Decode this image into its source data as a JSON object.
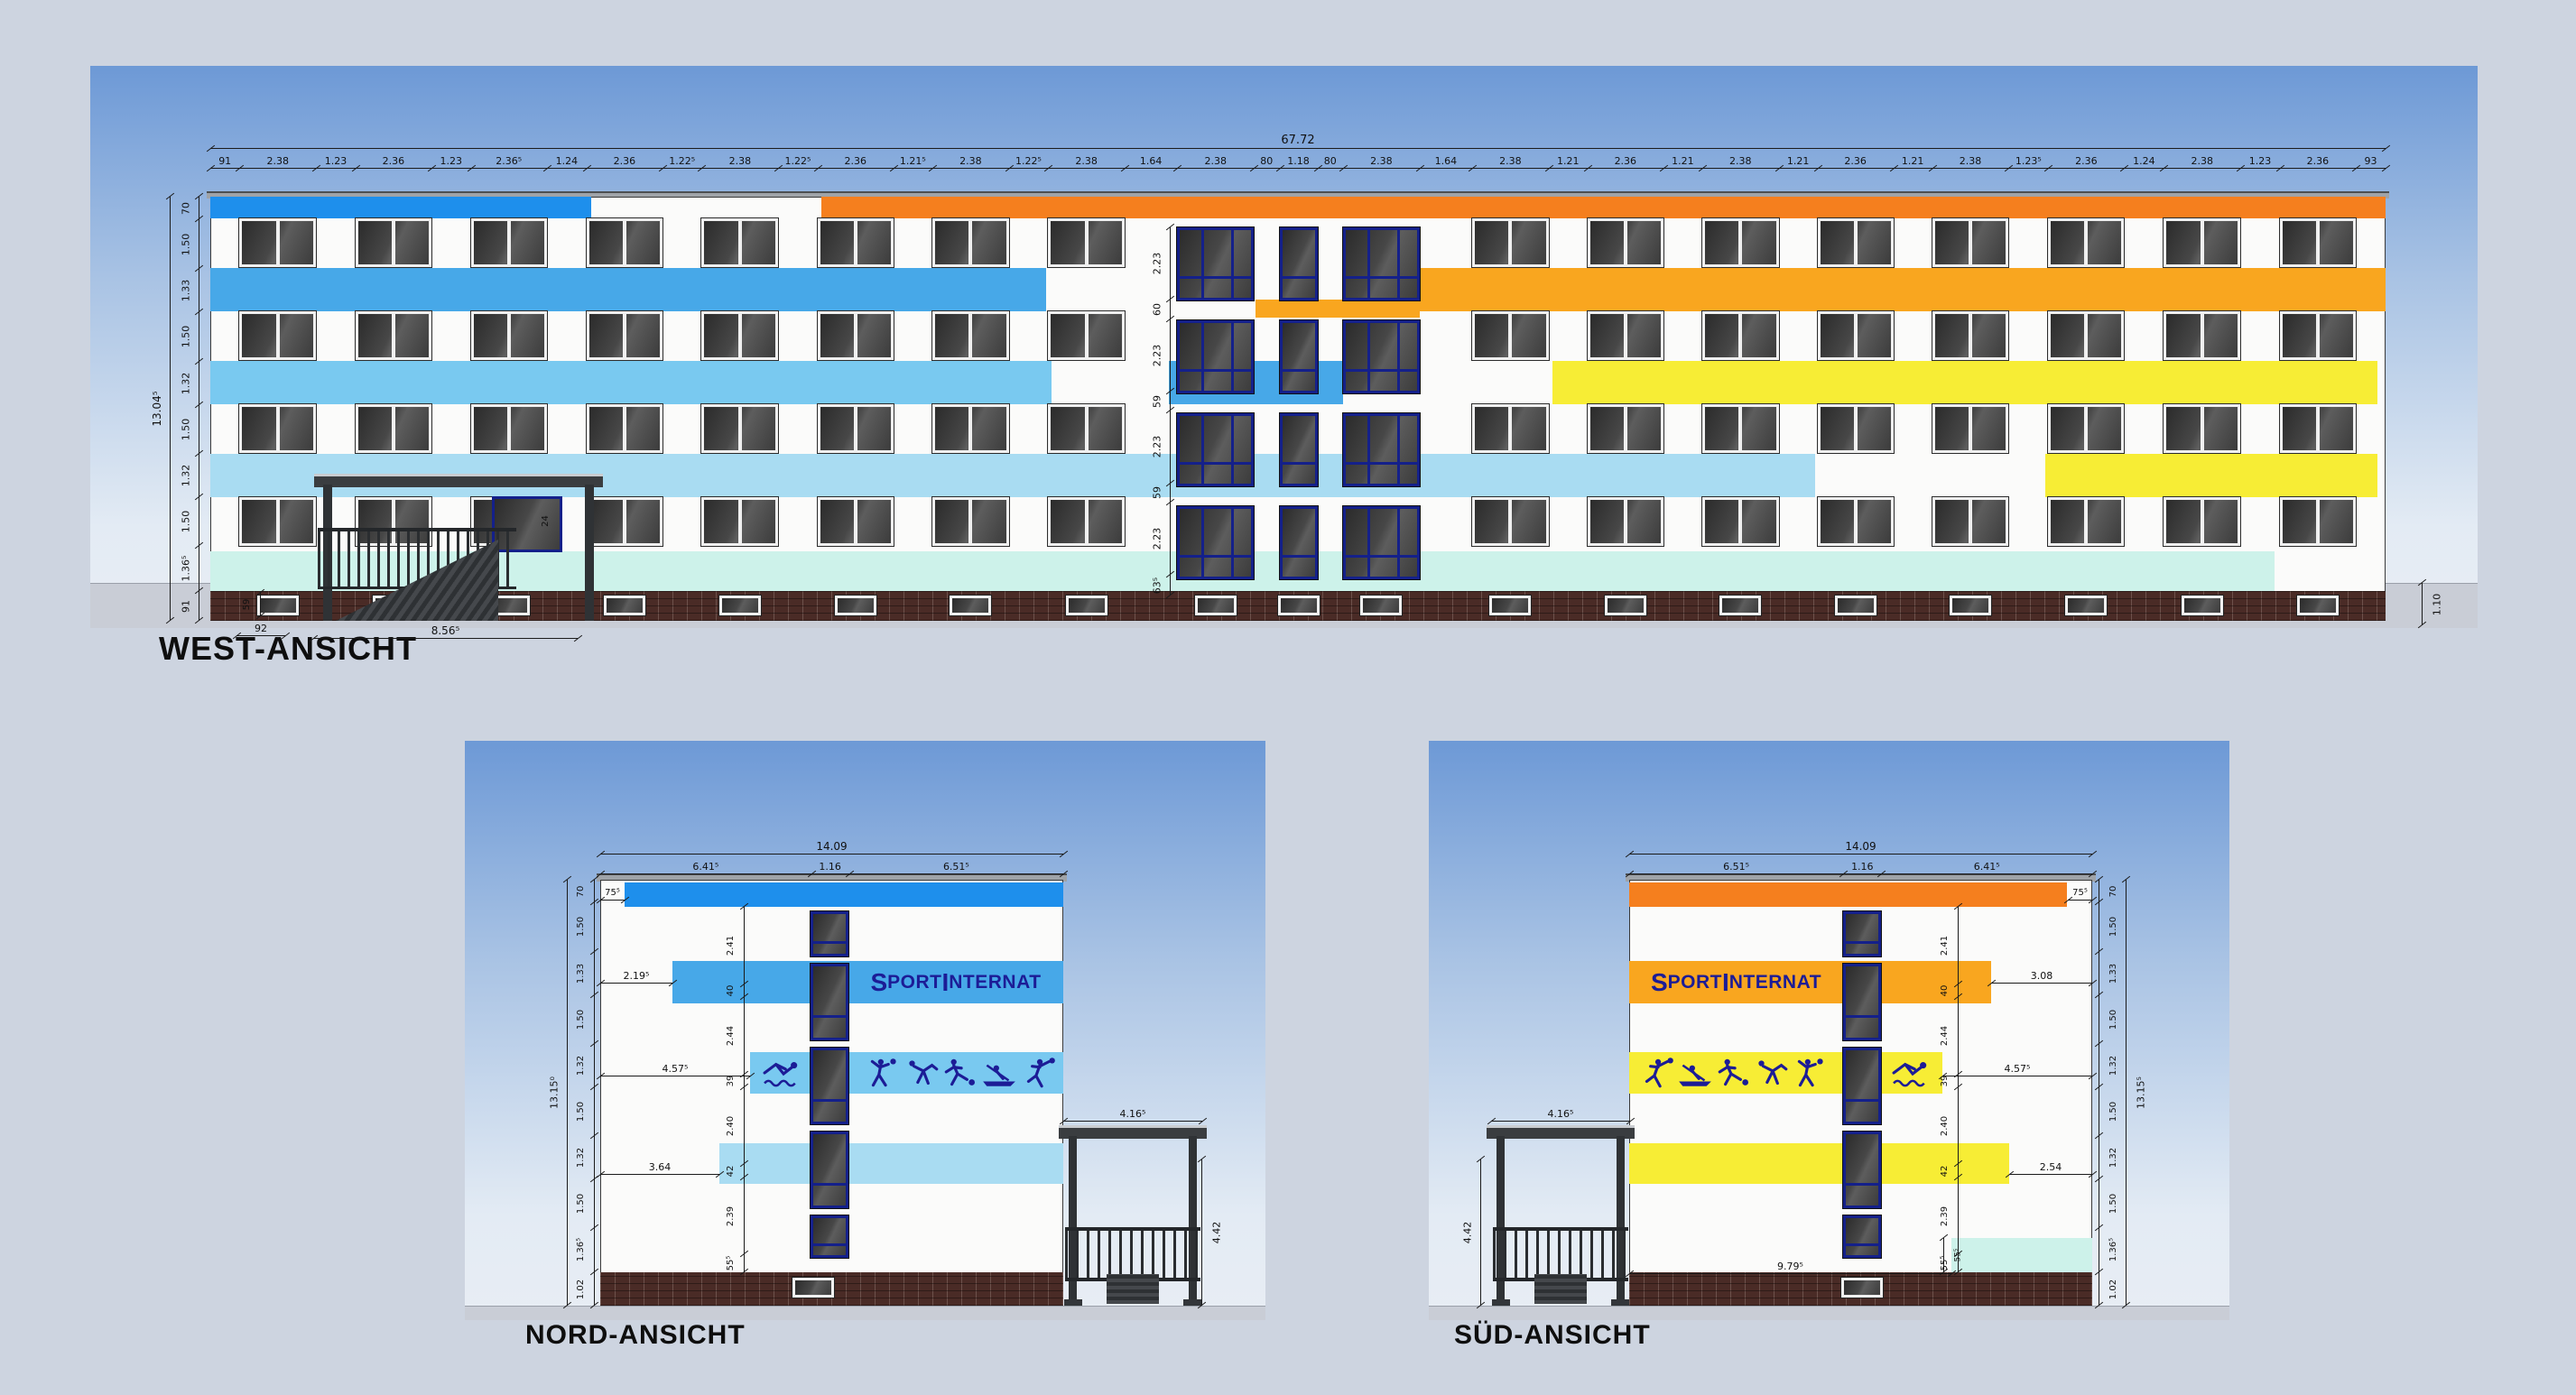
{
  "labels": {
    "west": "WEST-ANSICHT",
    "nord": "NORD-ANSICHT",
    "sued": "SÜD-ANSICHT"
  },
  "branding": {
    "lead": "S",
    "lead_rest": "PORT",
    "second": "I",
    "second_rest": "NTERNAT"
  },
  "colors": {
    "page_bg": "#cdd4e0",
    "sky_top": "#6d99d6",
    "sky_mid": "#a9c3e4",
    "sky_bottom": "#e3ebf4",
    "ground": "#c9cdd6",
    "roof": "#9fa3a8",
    "facade_white": "#fbfbfa",
    "strong_blue": "#1e8fec",
    "sky_blue": "#47a8e8",
    "mid_blue": "#79c9f0",
    "pale_blue": "#a9dcf2",
    "mint": "#cdf2ea",
    "orange": "#f57f1e",
    "amber": "#f9a61f",
    "yellow": "#f7ed35",
    "navy_frame": "#14208a",
    "navy_text": "#1c1c96",
    "brick": "#4a2b26",
    "window_frame": "#f0f0f0",
    "glass_dark": "#3a3a3a",
    "dim_line": "#1b1b1b"
  },
  "west": {
    "total_width": {
      "t": "67.72",
      "v": 67.72
    },
    "total_height": {
      "t": "13.04⁵",
      "v": 13.045
    },
    "top_chain": [
      {
        "t": "91",
        "v": 0.91
      },
      {
        "t": "2.38",
        "v": 2.38
      },
      {
        "t": "1.23",
        "v": 1.23
      },
      {
        "t": "2.36",
        "v": 2.36
      },
      {
        "t": "1.23",
        "v": 1.23
      },
      {
        "t": "2.36⁵",
        "v": 2.365
      },
      {
        "t": "1.24",
        "v": 1.24
      },
      {
        "t": "2.36",
        "v": 2.36
      },
      {
        "t": "1.22⁵",
        "v": 1.225
      },
      {
        "t": "2.38",
        "v": 2.38
      },
      {
        "t": "1.22⁵",
        "v": 1.225
      },
      {
        "t": "2.36",
        "v": 2.36
      },
      {
        "t": "1.21⁵",
        "v": 1.215
      },
      {
        "t": "2.38",
        "v": 2.38
      },
      {
        "t": "1.22⁵",
        "v": 1.225
      },
      {
        "t": "2.38",
        "v": 2.38
      },
      {
        "t": "1.64",
        "v": 1.64
      },
      {
        "t": "2.38",
        "v": 2.38
      },
      {
        "t": "80",
        "v": 0.8
      },
      {
        "t": "1.18",
        "v": 1.18
      },
      {
        "t": "80",
        "v": 0.8
      },
      {
        "t": "2.38",
        "v": 2.38
      },
      {
        "t": "1.64",
        "v": 1.64
      },
      {
        "t": "2.38",
        "v": 2.38
      },
      {
        "t": "1.21",
        "v": 1.21
      },
      {
        "t": "2.36",
        "v": 2.36
      },
      {
        "t": "1.21",
        "v": 1.21
      },
      {
        "t": "2.38",
        "v": 2.38
      },
      {
        "t": "1.21",
        "v": 1.21
      },
      {
        "t": "2.36",
        "v": 2.36
      },
      {
        "t": "1.21",
        "v": 1.21
      },
      {
        "t": "2.38",
        "v": 2.38
      },
      {
        "t": "1.23⁵",
        "v": 1.235
      },
      {
        "t": "2.36",
        "v": 2.36
      },
      {
        "t": "1.24",
        "v": 1.24
      },
      {
        "t": "2.38",
        "v": 2.38
      },
      {
        "t": "1.23",
        "v": 1.23
      },
      {
        "t": "2.36",
        "v": 2.36
      },
      {
        "t": "93",
        "v": 0.93
      }
    ],
    "left_chain": [
      {
        "t": "70",
        "v": 0.7
      },
      {
        "t": "1.50",
        "v": 1.5
      },
      {
        "t": "1.33",
        "v": 1.33
      },
      {
        "t": "1.50",
        "v": 1.5
      },
      {
        "t": "1.32",
        "v": 1.32
      },
      {
        "t": "1.50",
        "v": 1.5
      },
      {
        "t": "1.32",
        "v": 1.32
      },
      {
        "t": "1.50",
        "v": 1.5
      },
      {
        "t": "1.36⁵",
        "v": 1.365
      },
      {
        "t": "91",
        "v": 0.91
      }
    ],
    "center_chain": [
      {
        "t": "2.23",
        "v": 2.23
      },
      {
        "t": "60",
        "v": 0.6
      },
      {
        "t": "2.23",
        "v": 2.23
      },
      {
        "t": "59",
        "v": 0.59
      },
      {
        "t": "2.23",
        "v": 2.23
      },
      {
        "t": "59",
        "v": 0.59
      },
      {
        "t": "2.23",
        "v": 2.23
      },
      {
        "t": "63⁵",
        "v": 0.635
      }
    ],
    "base_dims": {
      "base_left_height": "91",
      "basement_window_height": "59",
      "basement_window_offset": "92",
      "porch_width": "8.56⁵",
      "right_plinth_height": "1.10",
      "door_dim": "24"
    }
  },
  "nord": {
    "width_total": {
      "t": "14.09",
      "v": 14.09
    },
    "width_parts": [
      {
        "t": "6.41⁵",
        "v": 6.415
      },
      {
        "t": "1.16",
        "v": 1.16
      },
      {
        "t": "6.51⁵",
        "v": 6.515
      }
    ],
    "height_total": {
      "t": "13.15⁰",
      "v": 13.15
    },
    "side_chain": [
      {
        "t": "70",
        "v": 0.7
      },
      {
        "t": "1.50",
        "v": 1.5
      },
      {
        "t": "1.33",
        "v": 1.33
      },
      {
        "t": "1.50",
        "v": 1.5
      },
      {
        "t": "1.32",
        "v": 1.32
      },
      {
        "t": "1.50",
        "v": 1.5
      },
      {
        "t": "1.32",
        "v": 1.32
      },
      {
        "t": "1.50",
        "v": 1.5
      },
      {
        "t": "1.36⁵",
        "v": 1.365
      },
      {
        "t": "1.02",
        "v": 1.02
      }
    ],
    "inner_chain": [
      {
        "t": "2.41",
        "v": 2.41
      },
      {
        "t": "40",
        "v": 0.4
      },
      {
        "t": "2.44",
        "v": 2.44
      },
      {
        "t": "39",
        "v": 0.39
      },
      {
        "t": "2.40",
        "v": 2.4
      },
      {
        "t": "42",
        "v": 0.42
      },
      {
        "t": "2.39",
        "v": 2.39
      },
      {
        "t": "55⁵",
        "v": 0.555
      }
    ],
    "band_offsets": {
      "top_notch": "75⁵",
      "blue_band": "2.19⁵",
      "picto_band": "4.57⁵",
      "pale_band": "3.64"
    },
    "porch": {
      "width": "4.16⁵",
      "height": "4.42"
    },
    "pictograms": [
      "swimming",
      "volleyball",
      "judo",
      "soccer",
      "rowing",
      "handball"
    ]
  },
  "sued": {
    "width_total": {
      "t": "14.09",
      "v": 14.09
    },
    "width_parts": [
      {
        "t": "6.51⁵",
        "v": 6.515
      },
      {
        "t": "1.16",
        "v": 1.16
      },
      {
        "t": "6.41⁵",
        "v": 6.415
      }
    ],
    "height_total": {
      "t": "13.15⁵",
      "v": 13.155
    },
    "side_chain": [
      {
        "t": "70",
        "v": 0.7
      },
      {
        "t": "1.50",
        "v": 1.5
      },
      {
        "t": "1.33",
        "v": 1.33
      },
      {
        "t": "1.50",
        "v": 1.5
      },
      {
        "t": "1.32",
        "v": 1.32
      },
      {
        "t": "1.50",
        "v": 1.5
      },
      {
        "t": "1.32",
        "v": 1.32
      },
      {
        "t": "1.50",
        "v": 1.5
      },
      {
        "t": "1.36⁵",
        "v": 1.365
      },
      {
        "t": "1.02",
        "v": 1.02
      }
    ],
    "inner_chain": [
      {
        "t": "2.41",
        "v": 2.41
      },
      {
        "t": "40",
        "v": 0.4
      },
      {
        "t": "2.44",
        "v": 2.44
      },
      {
        "t": "39",
        "v": 0.39
      },
      {
        "t": "2.40",
        "v": 2.4
      },
      {
        "t": "42",
        "v": 0.42
      },
      {
        "t": "2.39",
        "v": 2.39
      },
      {
        "t": "55⁵",
        "v": 0.555
      }
    ],
    "band_offsets": {
      "top_notch": "75⁵",
      "orange_band": "3.08",
      "picto_band": "4.57⁵",
      "yellow_band": "2.54",
      "mint_offset": "9.79⁵",
      "mint_height": "55⁵"
    },
    "porch": {
      "width": "4.16⁵",
      "height": "4.42"
    },
    "pictograms": [
      "handball",
      "rowing",
      "soccer",
      "judo",
      "volleyball",
      "swimming"
    ]
  }
}
